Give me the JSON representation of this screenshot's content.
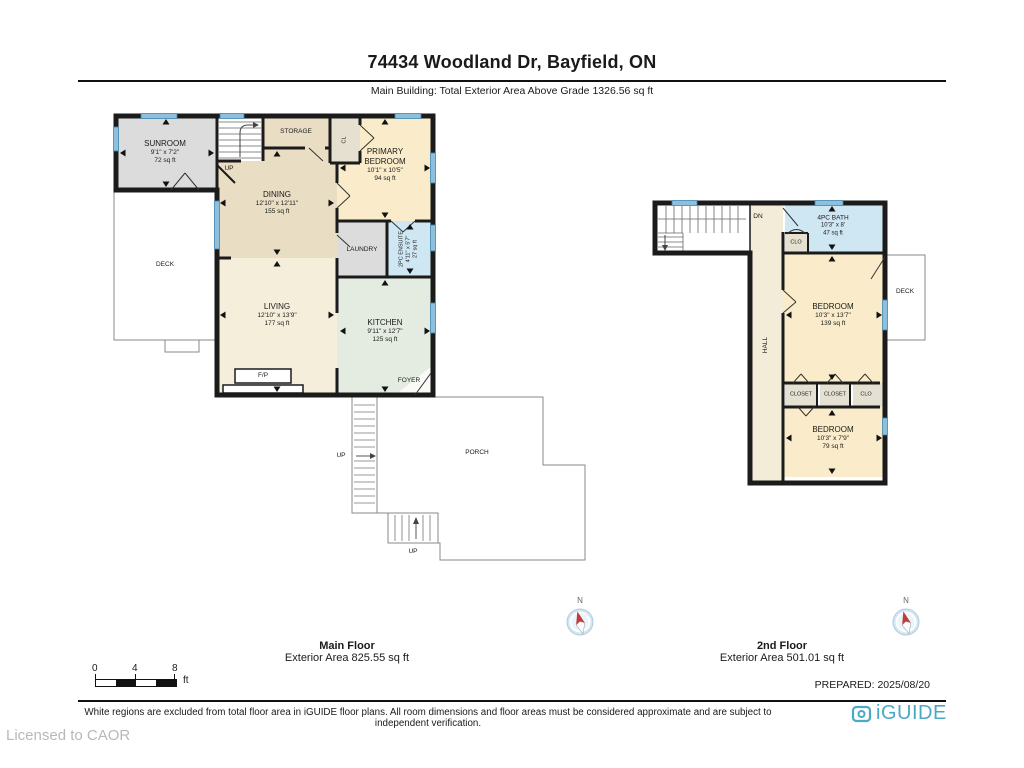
{
  "header": {
    "title": "74434 Woodland Dr, Bayfield, ON",
    "subtitle": "Main Building: Total Exterior Area Above Grade 1326.56 sq ft"
  },
  "main_floor": {
    "caption_title": "Main Floor",
    "caption_area": "Exterior Area 825.55 sq ft",
    "rooms": {
      "sunroom": {
        "name": "SUNROOM",
        "dims": "9'1\" x 7'2\"",
        "area": "72 sq ft"
      },
      "storage": {
        "name": "STORAGE"
      },
      "cl": {
        "name": "CL"
      },
      "primary": {
        "name": "PRIMARY BEDROOM",
        "dims": "10'1\" x 10'5\"",
        "area": "94 sq ft"
      },
      "dining": {
        "name": "DINING",
        "dims": "12'10\" x 12'11\"",
        "area": "155 sq ft"
      },
      "laundry": {
        "name": "LAUNDRY"
      },
      "ensuite": {
        "name": "2PC ENSUITE",
        "dims": "4'11\" x 5'7\"",
        "area": "27 sq ft"
      },
      "living": {
        "name": "LIVING",
        "dims": "12'10\" x 13'9\"",
        "area": "177 sq ft"
      },
      "kitchen": {
        "name": "KITCHEN",
        "dims": "9'11\" x 12'7\"",
        "area": "125 sq ft"
      },
      "foyer": {
        "name": "FOYER"
      },
      "fireplace": {
        "name": "F/P"
      },
      "deck": {
        "name": "DECK"
      },
      "porch": {
        "name": "PORCH"
      },
      "stairs_up": {
        "name": "UP"
      }
    }
  },
  "second_floor": {
    "caption_title": "2nd Floor",
    "caption_area": "Exterior Area 501.01 sq ft",
    "rooms": {
      "stairs_dn": {
        "name": "DN"
      },
      "bath": {
        "name": "4PC BATH",
        "dims": "10'3\" x 8'",
        "area": "47 sq ft"
      },
      "clo_bath": {
        "name": "CLO"
      },
      "hall": {
        "name": "HALL"
      },
      "bedroom_large": {
        "name": "BEDROOM",
        "dims": "10'3\" x 13'7\"",
        "area": "139 sq ft"
      },
      "deck": {
        "name": "DECK"
      },
      "closet1": {
        "name": "CLOSET"
      },
      "closet2": {
        "name": "CLOSET"
      },
      "clo": {
        "name": "CLO"
      },
      "bedroom_small": {
        "name": "BEDROOM",
        "dims": "10'3\" x 7'9\"",
        "area": "79 sq ft"
      }
    }
  },
  "scale_bar": {
    "tick0": "0",
    "tick1": "4",
    "tick2": "8",
    "unit": "ft"
  },
  "compass": {
    "north": "N"
  },
  "footer": {
    "prepared": "PREPARED: 2025/08/20",
    "disclaimer": "White regions are excluded from total floor area in iGUIDE floor plans. All room dimensions and floor areas must be considered approximate and are subject to independent verification.",
    "brand": "iGUIDE",
    "licensed": "Licensed to CAOR"
  },
  "palette": {
    "wall": "#1b1b1b",
    "room_beige": "#e9ddc4",
    "room_yellow": "#faecca",
    "room_cream": "#f5eedb",
    "room_mint": "#e4ece2",
    "room_gray": "#dcdcdc",
    "room_blue": "#cfe6f3",
    "closet_tan": "#e6e0d0",
    "window_blue": "#8cc0dc",
    "brand_teal": "#4aa9c6"
  }
}
